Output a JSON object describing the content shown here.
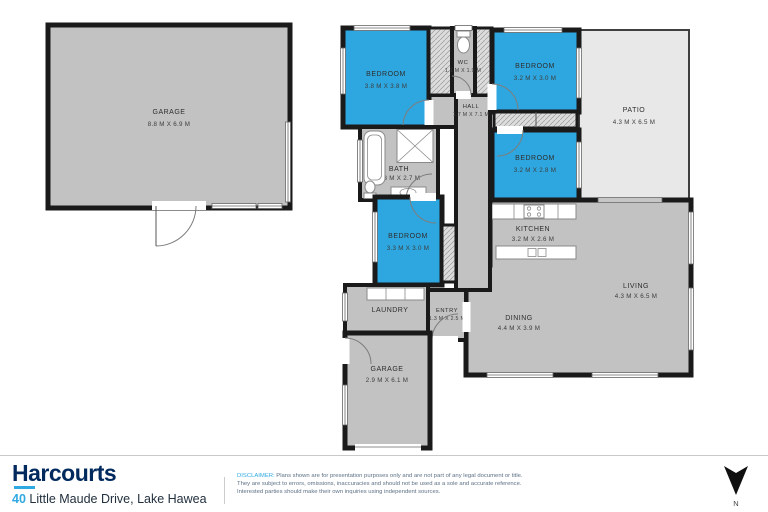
{
  "floorplan": {
    "rooms": [
      {
        "name": "GARAGE",
        "dims": "8.8 M X 6.9 M"
      },
      {
        "name": "BEDROOM",
        "dims": "3.8 M X 3.8 M"
      },
      {
        "name": "WC",
        "dims": "1.1 M X 1.9 M"
      },
      {
        "name": "BEDROOM",
        "dims": "3.2 M X 3.0 M"
      },
      {
        "name": "PATIO",
        "dims": "4.3 M X 6.5 M"
      },
      {
        "name": "HALL",
        "dims": "1.7 M X 7.1 M"
      },
      {
        "name": "BATH",
        "dims": "3.3 M X 2.7 M"
      },
      {
        "name": "BEDROOM",
        "dims": "3.2 M X 2.8 M"
      },
      {
        "name": "KITCHEN",
        "dims": "3.2 M X 2.6 M"
      },
      {
        "name": "BEDROOM",
        "dims": "3.3 M X 3.0 M"
      },
      {
        "name": "LIVING",
        "dims": "4.3 M X 6.5 M"
      },
      {
        "name": "DINING",
        "dims": "4.4 M X 3.9 M"
      },
      {
        "name": "LAUNDRY",
        "dims": ""
      },
      {
        "name": "ENTRY",
        "dims": "1.3 M X 2.5 M"
      },
      {
        "name": "GARAGE",
        "dims": "2.9 M X 6.1 M"
      }
    ]
  },
  "footer": {
    "brand": "Harcourts",
    "address_number": "40",
    "address": "Little Maude Drive, Lake Hawea",
    "disclaimer_label": "DISCLAIMER:",
    "disclaimer_text": "Plans shown are for presentation purposes only and are not part of any legal document or title. They are subject to errors, omissions, inaccuracies and should not be used as a sole and accurate reference. Interested parties should make their own inquiries using independent sources.",
    "compass_label": "N"
  },
  "colors": {
    "bedroom_blue": "#2EA7E0",
    "room_gray": "#C2C2C2",
    "patio_gray": "#E8E8E8",
    "wall_black": "#1A1A1A",
    "brand_navy": "#00295E",
    "accent_cyan": "#2FA9E1",
    "footer_text": "#5D7085"
  }
}
